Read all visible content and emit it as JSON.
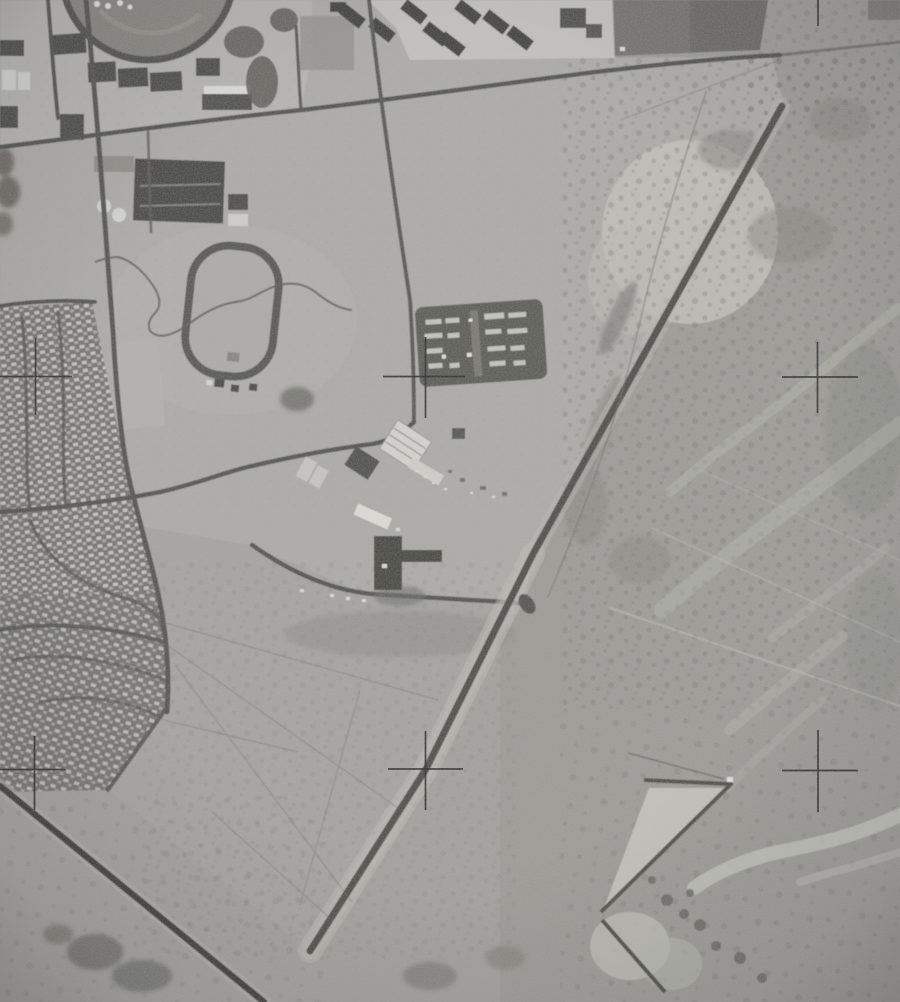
{
  "scene": {
    "description": "Grainy black-and-white vertical aerial photograph: a desert-edge town with a school campus, oval racetrack, dense housing tract and a diagonal airstrip running from upper right to lower left, bordered by scrub desert with braided washes; six fiducial cross registration marks are printed over the image",
    "orientation": "overhead vertical survey view",
    "tone": "grainy monochrome film"
  },
  "palette": {
    "ground": "#a09f9b",
    "fields": "#abaaa6",
    "campus_ground": "#b5b4b0",
    "desert": "#9a9994",
    "housing_base": "#6f6e6a",
    "house_roofs": "#cfcec9",
    "roads": "#4a4a46",
    "runway": "#454543",
    "highway": "#343433",
    "bright_sand": "#c5c4be",
    "dark_buildings": "#403f3c",
    "white_buildings": "#d7d6d1",
    "fiducial_marks": "#202020"
  },
  "features": [
    {
      "name": "stadium-ring",
      "description": "dark circular running-track ring cut by the top edge",
      "approx_position": "top left, x60-230 y0-60"
    },
    {
      "name": "school-campus",
      "description": "light ground with rows of dark flat-roofed buildings, white gym roofs and two round white tanks",
      "approx_position": "upper left quarter"
    },
    {
      "name": "gymnasium-building",
      "description": "large dark rectangular building with light ridge lines",
      "approx_position": "x135-225 y160-225"
    },
    {
      "name": "barracks-cluster",
      "description": "angled dark rectangular buildings on bright ground",
      "approx_position": "top center, x330-545 y0-58"
    },
    {
      "name": "dark-fields",
      "description": "dark rectangular cultivated parcel",
      "approx_position": "top right of center, x612-768 y0-56"
    },
    {
      "name": "racetrack-oval",
      "description": "D-shaped dark track outline with small sheds at its south end",
      "approx_position": "x185-278 y243-390"
    },
    {
      "name": "winding-path",
      "description": "thin meandering creek/footpath crossing the field and track",
      "approx_position": "x95-352 y255-335"
    },
    {
      "name": "housing-tract",
      "description": "dense rows of small light-roofed houses on dark ground with curving streets",
      "approx_position": "left edge, y300-790"
    },
    {
      "name": "trailer-court",
      "description": "dark rectangular compound filled with rows of light trailers",
      "approx_position": "x415-545 y300-385"
    },
    {
      "name": "airfield-buildings",
      "description": "white hangar with ridged roof, white barracks bars, dark T-shaped building with shadow, scattered vehicles",
      "approx_position": "x300-530 y420-610"
    },
    {
      "name": "runway",
      "description": "dark diagonal airstrip with light graded shoulders",
      "approx_position": "from x782 y106 to x310 y952"
    },
    {
      "name": "road-grid",
      "description": "dark section roads: long top road, S-curved tract road, connector to runway junction",
      "approx_position": "upper and center left"
    },
    {
      "name": "main-highway",
      "description": "wide very dark highway with light shoulders",
      "approx_position": "bottom left, x0 y786 to x264 y1002"
    },
    {
      "name": "earthwork-dike",
      "description": "angled dike lines forming an arrow/Z shape around bright graded sand",
      "approx_position": "bottom right, x600-731 y750-992"
    },
    {
      "name": "desert-washes",
      "description": "light braided drainage channels through mottled scrub",
      "approx_position": "right third"
    },
    {
      "name": "desert-scrub",
      "description": "speckled creosote-bush desert with thin vehicle trails",
      "approx_position": "right half and bottom"
    },
    {
      "name": "fiducial-crosses",
      "description": "thin black register crosses printed on the photo",
      "approx_position": "two rows of three, y377 and y770, plus tick at top right"
    }
  ],
  "fiducial_marks": {
    "count": 7,
    "centers": [
      {
        "x": 35,
        "y": 377
      },
      {
        "x": 425,
        "y": 377
      },
      {
        "x": 818,
        "y": 377
      },
      {
        "x": 34,
        "y": 770
      },
      {
        "x": 425,
        "y": 769
      },
      {
        "x": 818,
        "y": 771
      },
      {
        "x": 818,
        "y": 13,
        "type": "edge-tick"
      }
    ]
  }
}
